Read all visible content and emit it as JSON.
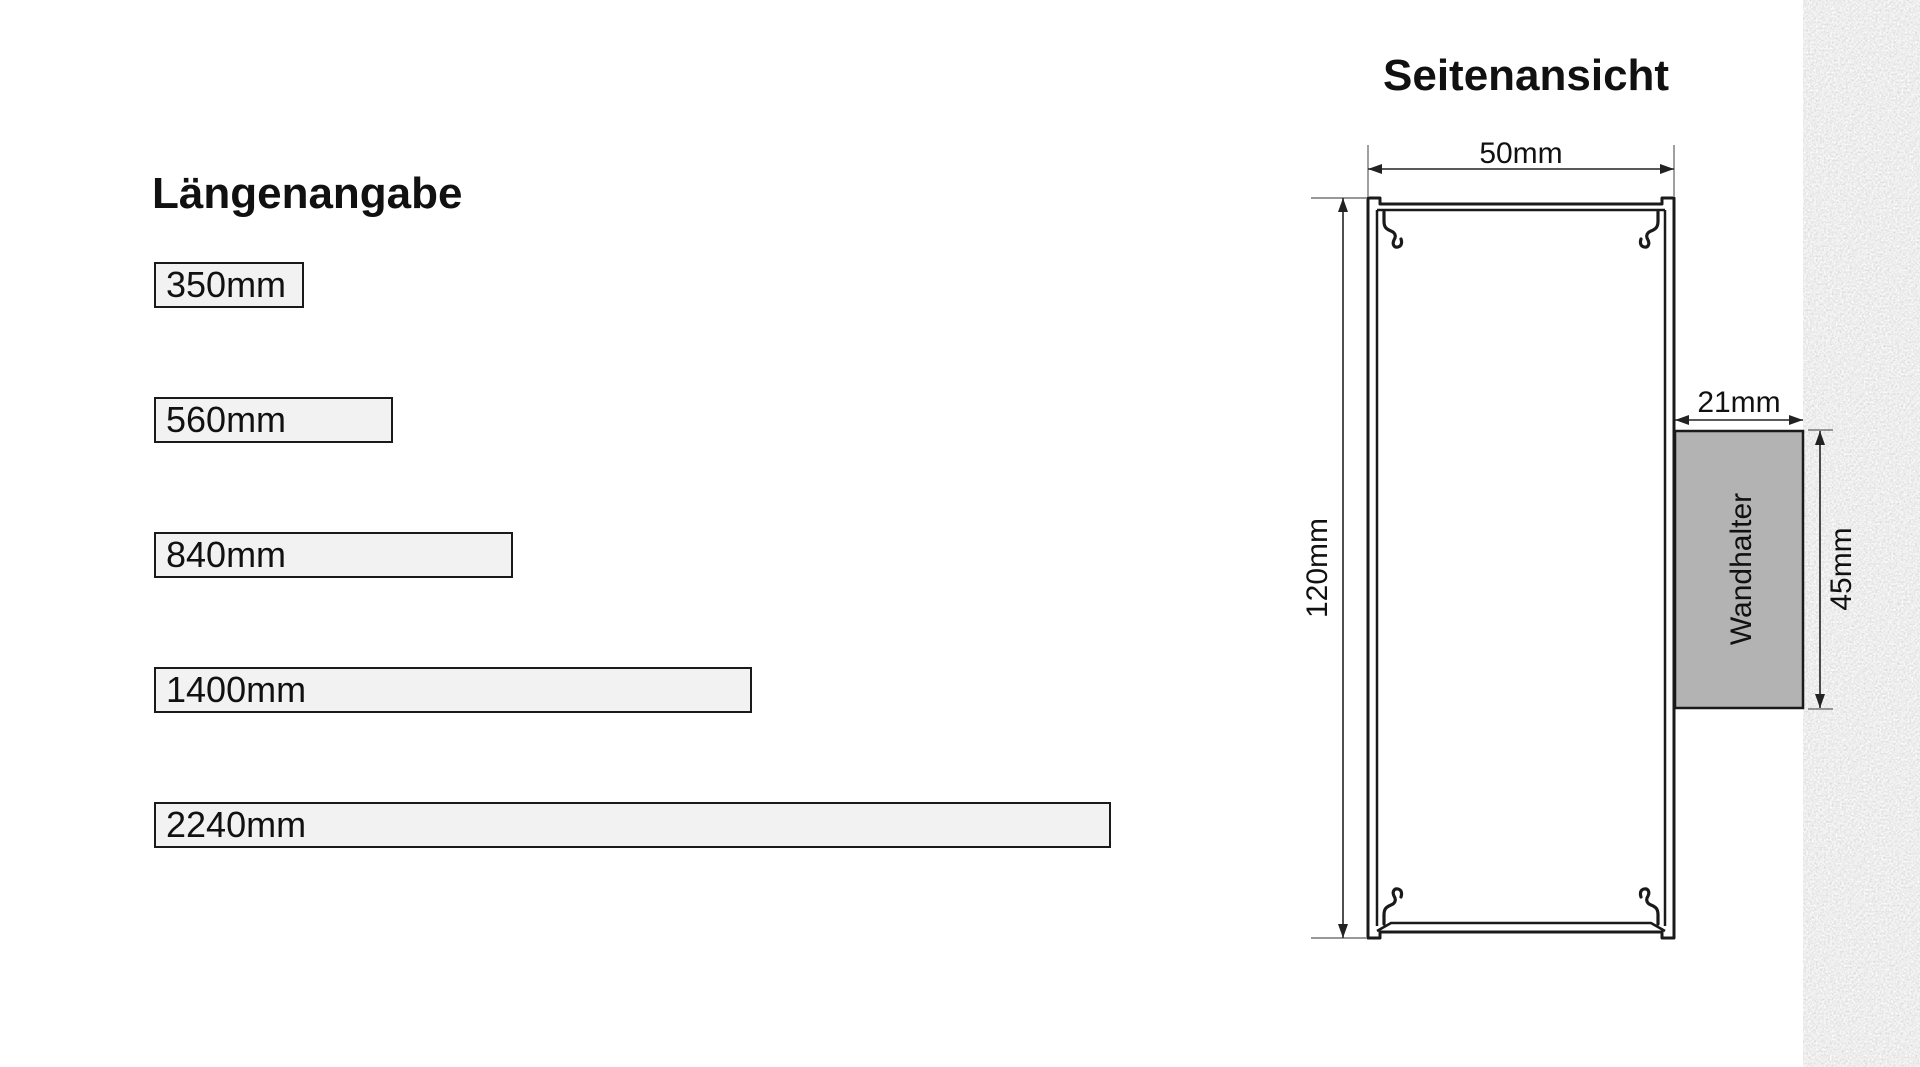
{
  "lengths_panel": {
    "title": "Längenangabe",
    "bars": [
      {
        "label": "350mm",
        "mm": 350
      },
      {
        "label": "560mm",
        "mm": 560
      },
      {
        "label": "840mm",
        "mm": 840
      },
      {
        "label": "1400mm",
        "mm": 1400
      },
      {
        "label": "2240mm",
        "mm": 2240
      }
    ],
    "bar_fill": "#f2f2f2",
    "bar_border": "#1a1a1a"
  },
  "side_view": {
    "title": "Seitenansicht",
    "dim_width": "50mm",
    "dim_height": "120mm",
    "dim_holder_width": "21mm",
    "dim_holder_height": "45mm",
    "wall_holder_label": "Wandhalter",
    "holder_fill": "#b3b3b3",
    "line_color": "#1a1a1a"
  }
}
